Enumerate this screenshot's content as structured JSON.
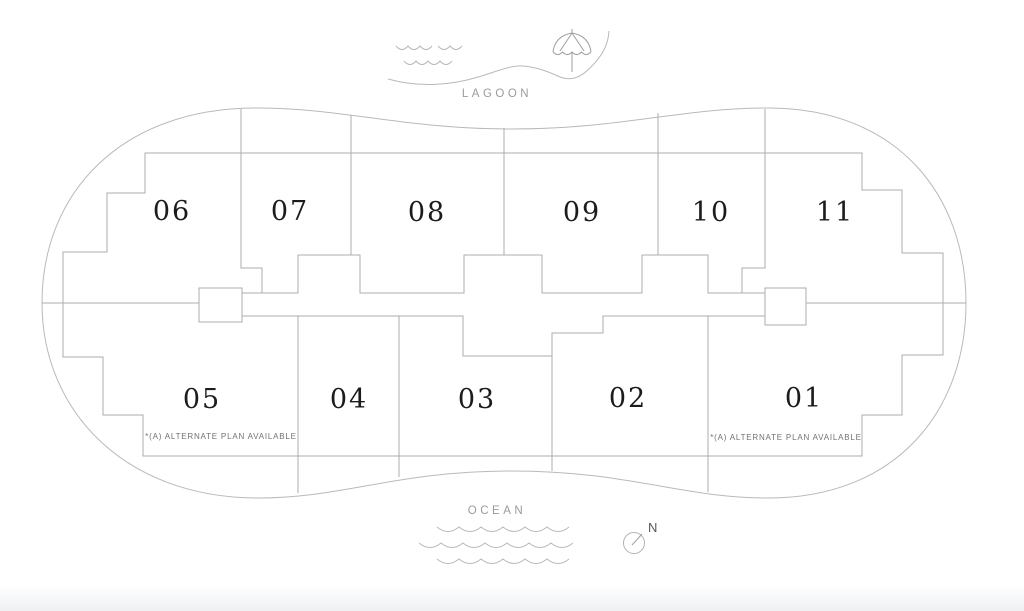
{
  "page": {
    "background": "#ffffff"
  },
  "legend": {
    "lagoon_label": "LAGOON",
    "ocean_label": "OCEAN",
    "compass_label": "N"
  },
  "units": {
    "top_row": [
      {
        "number": "06"
      },
      {
        "number": "07"
      },
      {
        "number": "08"
      },
      {
        "number": "09"
      },
      {
        "number": "10"
      },
      {
        "number": "11"
      }
    ],
    "bottom_row": [
      {
        "number": "05",
        "note": "*(A) ALTERNATE PLAN AVAILABLE"
      },
      {
        "number": "04"
      },
      {
        "number": "03"
      },
      {
        "number": "02"
      },
      {
        "number": "01",
        "note": "*(A) ALTERNATE PLAN AVAILABLE"
      }
    ]
  },
  "icons": {
    "umbrella": "beach-umbrella-icon",
    "compass": "compass-north-icon",
    "lagoon_waves": "water-waves-icon",
    "ocean_waves": "water-waves-icon"
  },
  "colors": {
    "site_outline": "#b6babe",
    "interior_line": "#a9aeb2",
    "unit_number": "#1c1c1c",
    "water_label": "#979ca1",
    "note_text": "#6e7378",
    "north_label": "#54585c",
    "bottom_fade": "#f0f1f3"
  }
}
